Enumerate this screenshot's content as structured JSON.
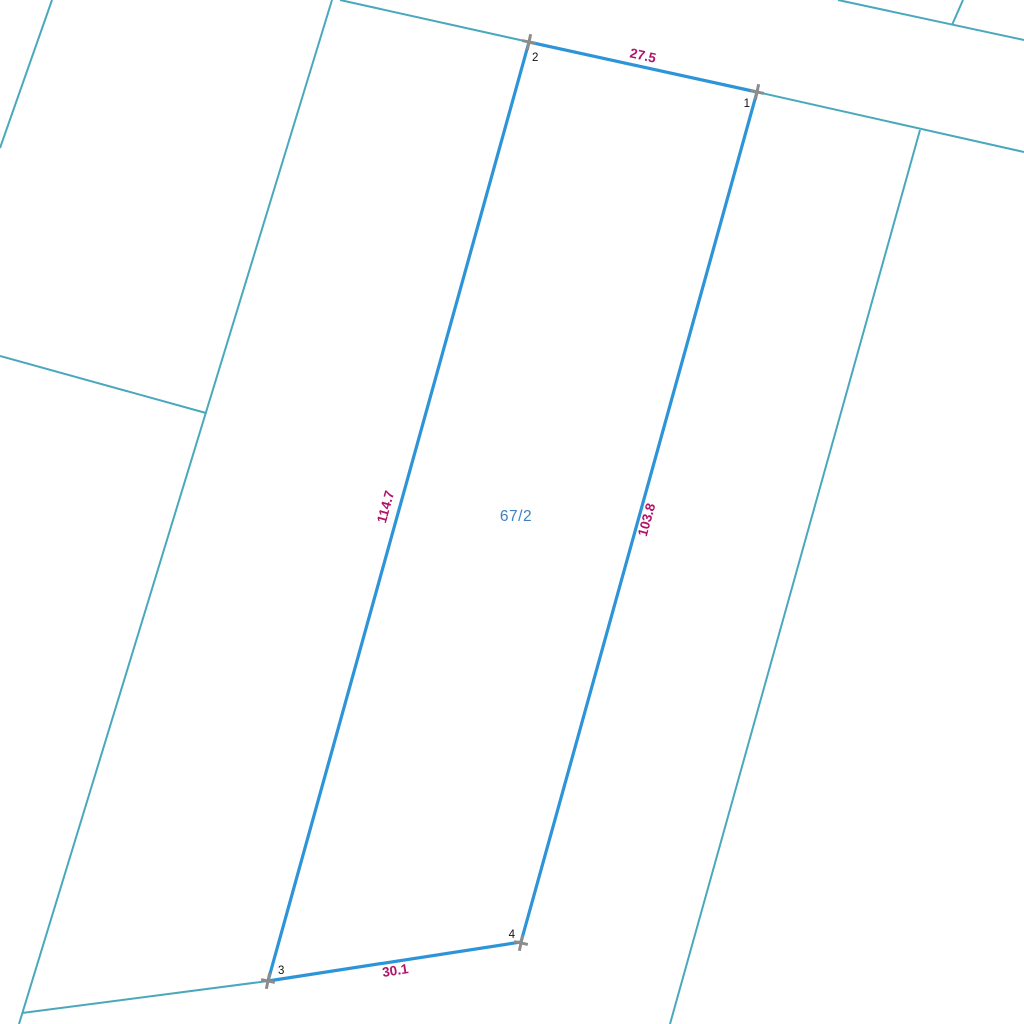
{
  "map": {
    "kind": "cadastral-parcel-map",
    "background": "#ffffff",
    "colors": {
      "parcel_boundary": "#2E94D8",
      "neighbor_boundary": "#4AA8BC",
      "measurement_text": "#B0136A",
      "parcel_label_text": "#3C80C0",
      "vertex_marker": "#8C8C8C",
      "vertex_number_text": "#111111"
    },
    "parcel": {
      "label": "67/2",
      "vertices": [
        {
          "number": "1"
        },
        {
          "number": "2"
        },
        {
          "number": "3"
        },
        {
          "number": "4"
        }
      ],
      "edges": [
        {
          "from": "2",
          "to": "1",
          "length": "27.5"
        },
        {
          "from": "2",
          "to": "3",
          "length": "114.7"
        },
        {
          "from": "3",
          "to": "4",
          "length": "30.1"
        },
        {
          "from": "4",
          "to": "1",
          "length": "103.8"
        }
      ]
    }
  }
}
